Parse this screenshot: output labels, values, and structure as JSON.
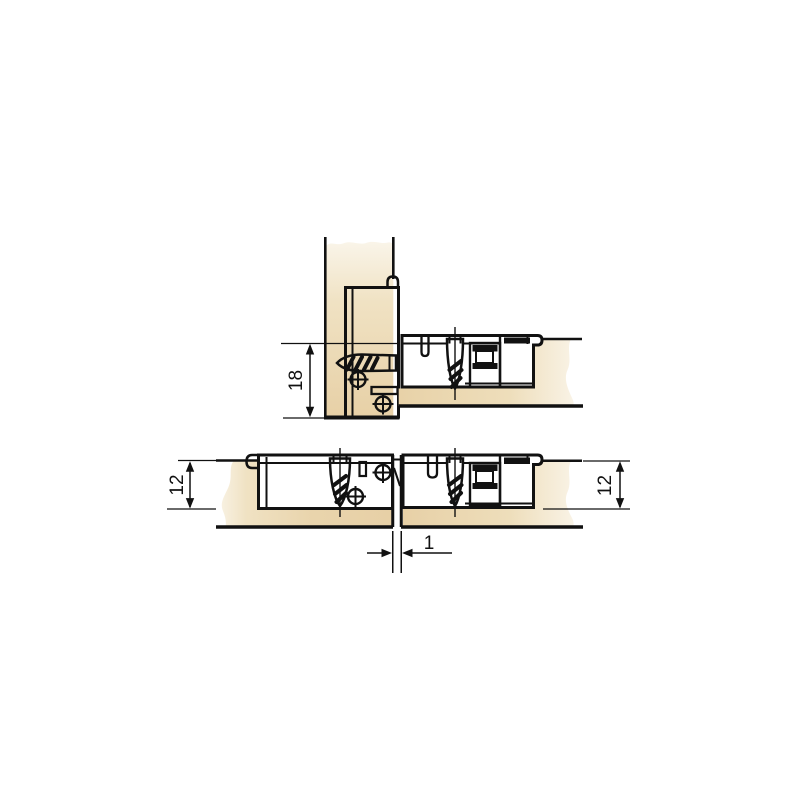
{
  "diagram": {
    "kind": "furniture-connector-cross-section",
    "background_color": "#ffffff",
    "line_color": "#111111",
    "wood_color": "#e9d4ac",
    "wood_highlight_color": "#f8f2e4",
    "fitting_color": "#dde3eb",
    "fitting_highlight_color": "#f2f4f8",
    "dimensions": {
      "top_offset": "18",
      "left_depth": "12",
      "right_depth": "12",
      "gap": "1"
    }
  }
}
